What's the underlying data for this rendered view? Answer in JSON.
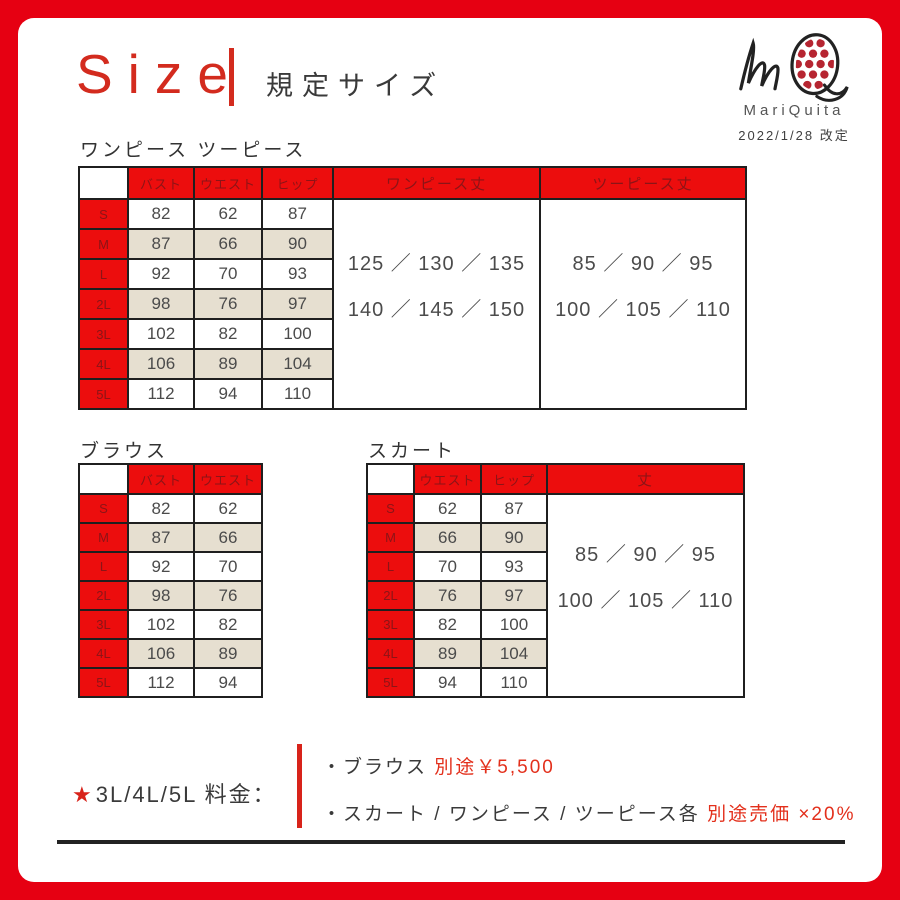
{
  "header": {
    "title_en": "Size",
    "title_ja": "規定サイズ",
    "brand_name": "MariQuita",
    "revision": "2022/1/28 改定"
  },
  "colors": {
    "frame_red": "#e60012",
    "table_header_red": "#ec0d0d",
    "table_header_text": "#8c1417",
    "accent_red": "#e3301c",
    "row_beige": "#e6dfd0"
  },
  "onepiece": {
    "section_label": "ワンピース ツーピース",
    "columns": [
      "バスト",
      "ウエスト",
      "ヒップ"
    ],
    "length_columns": [
      {
        "header": "ワンピース丈",
        "line1": "125 ／ 130 ／ 135",
        "line2": "140 ／ 145 ／ 150"
      },
      {
        "header": "ツーピース丈",
        "line1": "85 ／ 90 ／ 95",
        "line2": "100 ／ 105 ／ 110"
      }
    ],
    "rows": [
      {
        "size": "S",
        "bust": "82",
        "waist": "62",
        "hip": "87"
      },
      {
        "size": "M",
        "bust": "87",
        "waist": "66",
        "hip": "90"
      },
      {
        "size": "L",
        "bust": "92",
        "waist": "70",
        "hip": "93"
      },
      {
        "size": "2L",
        "bust": "98",
        "waist": "76",
        "hip": "97"
      },
      {
        "size": "3L",
        "bust": "102",
        "waist": "82",
        "hip": "100"
      },
      {
        "size": "4L",
        "bust": "106",
        "waist": "89",
        "hip": "104"
      },
      {
        "size": "5L",
        "bust": "112",
        "waist": "94",
        "hip": "110"
      }
    ]
  },
  "blouse": {
    "section_label": "ブラウス",
    "columns": [
      "バスト",
      "ウエスト"
    ],
    "rows": [
      {
        "size": "S",
        "bust": "82",
        "waist": "62"
      },
      {
        "size": "M",
        "bust": "87",
        "waist": "66"
      },
      {
        "size": "L",
        "bust": "92",
        "waist": "70"
      },
      {
        "size": "2L",
        "bust": "98",
        "waist": "76"
      },
      {
        "size": "3L",
        "bust": "102",
        "waist": "82"
      },
      {
        "size": "4L",
        "bust": "106",
        "waist": "89"
      },
      {
        "size": "5L",
        "bust": "112",
        "waist": "94"
      }
    ]
  },
  "skirt": {
    "section_label": "スカート",
    "columns": [
      "ウエスト",
      "ヒップ"
    ],
    "length_column": {
      "header": "丈",
      "line1": "85 ／ 90 ／ 95",
      "line2": "100 ／ 105 ／ 110"
    },
    "rows": [
      {
        "size": "S",
        "waist": "62",
        "hip": "87"
      },
      {
        "size": "M",
        "waist": "66",
        "hip": "90"
      },
      {
        "size": "L",
        "waist": "70",
        "hip": "93"
      },
      {
        "size": "2L",
        "waist": "76",
        "hip": "97"
      },
      {
        "size": "3L",
        "waist": "82",
        "hip": "100"
      },
      {
        "size": "4L",
        "waist": "89",
        "hip": "104"
      },
      {
        "size": "5L",
        "waist": "94",
        "hip": "110"
      }
    ]
  },
  "pricing": {
    "star": "★",
    "label": "3L/4L/5L 料金：",
    "items": [
      {
        "text": "・ブラウス ",
        "highlight": "別途￥5,500"
      },
      {
        "text": "・スカート / ワンピース / ツーピース各 ",
        "highlight": "別途売価 ×20%"
      }
    ]
  }
}
